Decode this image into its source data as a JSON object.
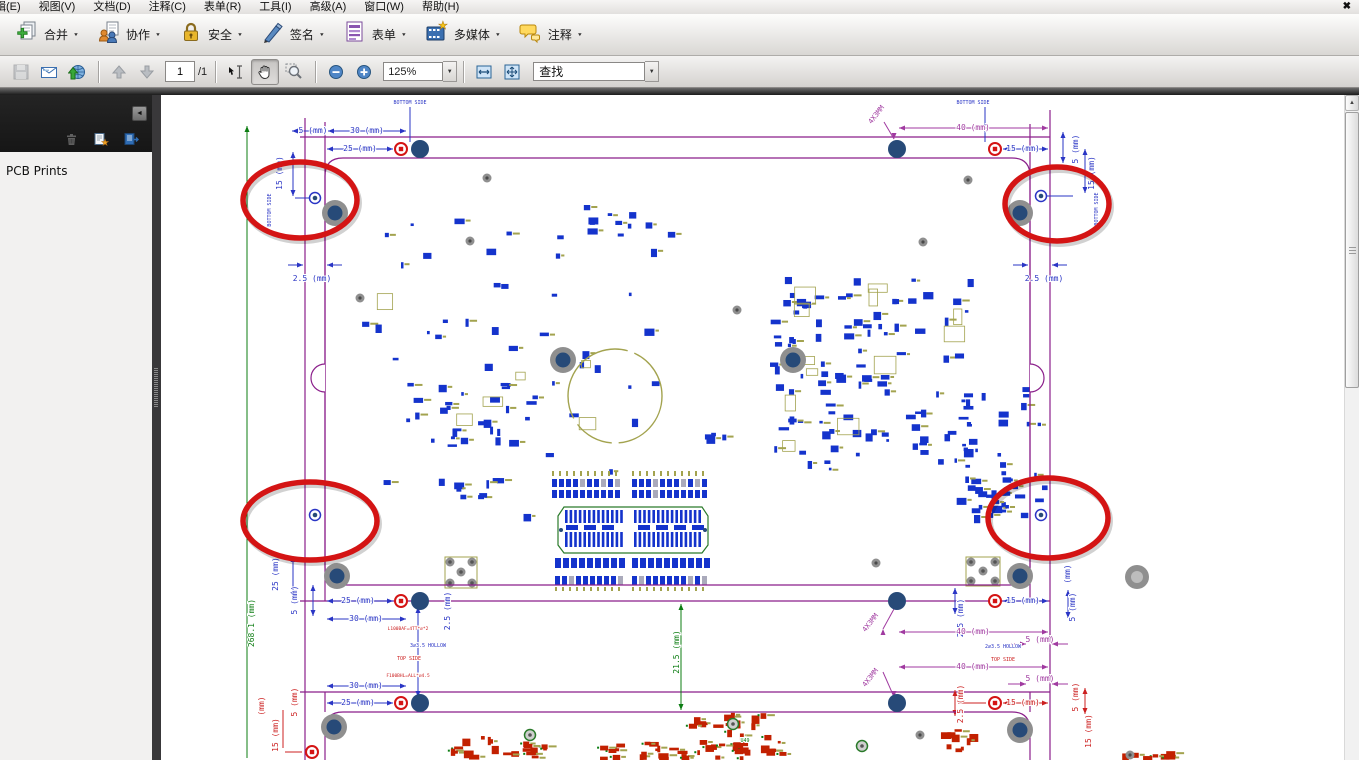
{
  "menu_bar": {
    "items": [
      "辑(E)",
      "视图(V)",
      "文档(D)",
      "注释(C)",
      "表单(R)",
      "工具(I)",
      "高级(A)",
      "窗口(W)",
      "帮助(H)"
    ],
    "close_glyph": "✖"
  },
  "toolbar_main": {
    "items": [
      {
        "id": "combine",
        "label": "合并"
      },
      {
        "id": "collaborate",
        "label": "协作"
      },
      {
        "id": "secure",
        "label": "安全"
      },
      {
        "id": "sign",
        "label": "签名"
      },
      {
        "id": "forms",
        "label": "表单"
      },
      {
        "id": "multimedia",
        "label": "多媒体"
      },
      {
        "id": "comment",
        "label": "注释"
      }
    ],
    "dropdown_glyph": "▼"
  },
  "toolbar_nav": {
    "page_current": "1",
    "page_total": "/1",
    "zoom_level": "125%",
    "find_value": "查找"
  },
  "sidebar": {
    "panel_title": "PCB Prints"
  },
  "drawing": {
    "palette": {
      "B": "#2a35c5",
      "P": "#a03aa0",
      "M": "#8b1f8b",
      "G": "#0c7d12",
      "R": "#cc2020",
      "O": "#a3a34f",
      "A": "#d41414",
      "N": "#274a78",
      "H": "#8f8f8f"
    },
    "labels": [
      {
        "t": "BOTTOM SIDE",
        "x": 410,
        "y": 104,
        "c": "B",
        "s": 5
      },
      {
        "t": "5 (mm)",
        "x": 313,
        "y": 133,
        "c": "B",
        "s": 8
      },
      {
        "t": "30 (mm)",
        "x": 367,
        "y": 133,
        "c": "B",
        "s": 8
      },
      {
        "t": "25 (mm)",
        "x": 360,
        "y": 151,
        "c": "B",
        "s": 8
      },
      {
        "t": "15 (mm)",
        "x": 282,
        "y": 173,
        "r": -90,
        "c": "B",
        "s": 8
      },
      {
        "t": "BOTTOM SIDE",
        "x": 271,
        "y": 210,
        "r": -90,
        "c": "B",
        "s": 5
      },
      {
        "t": "2.5 (mm)",
        "x": 312,
        "y": 281,
        "c": "B",
        "s": 8
      },
      {
        "t": "BOTTOM SIDE",
        "x": 973,
        "y": 104,
        "c": "B",
        "s": 5
      },
      {
        "t": "40 (mm)",
        "x": 973,
        "y": 130,
        "c": "P",
        "s": 8
      },
      {
        "t": "4X3MM",
        "x": 878,
        "y": 116,
        "r": -52,
        "c": "P",
        "s": 7
      },
      {
        "t": "15 (mm)",
        "x": 1023,
        "y": 151,
        "c": "B",
        "s": 8
      },
      {
        "t": "5 (mm)",
        "x": 1078,
        "y": 149,
        "r": -90,
        "c": "B",
        "s": 8
      },
      {
        "t": "15 (mm)",
        "x": 1094,
        "y": 173,
        "r": -90,
        "c": "B",
        "s": 8
      },
      {
        "t": "BOTTOM SIDE",
        "x": 1098,
        "y": 209,
        "r": -90,
        "c": "B",
        "s": 5
      },
      {
        "t": "2.5 (mm)",
        "x": 1044,
        "y": 281,
        "c": "B",
        "s": 8
      },
      {
        "t": "25 (mm)",
        "x": 278,
        "y": 574,
        "r": -90,
        "c": "B",
        "s": 8
      },
      {
        "t": "5 (mm)",
        "x": 297,
        "y": 600,
        "r": -90,
        "c": "B",
        "s": 8
      },
      {
        "t": "25 (mm)",
        "x": 358,
        "y": 603,
        "c": "B",
        "s": 8
      },
      {
        "t": "30 (mm)",
        "x": 366,
        "y": 621,
        "c": "B",
        "s": 8
      },
      {
        "t": "2.5 (mm)",
        "x": 450,
        "y": 611,
        "r": -90,
        "c": "B",
        "s": 8
      },
      {
        "t": "L100BAF=4TT*⌀*2",
        "x": 408,
        "y": 630,
        "c": "R",
        "s": 4.5
      },
      {
        "t": "3⌀3.5 HOLLOW",
        "x": 428,
        "y": 647,
        "c": "B",
        "s": 5
      },
      {
        "t": "TOP SIDE",
        "x": 409,
        "y": 660,
        "c": "R",
        "s": 5
      },
      {
        "t": "F100BHL=ALL*⌀4.5",
        "x": 408,
        "y": 677,
        "c": "R",
        "s": 4.5
      },
      {
        "t": "268.1 (mm)",
        "x": 254,
        "y": 623,
        "r": -90,
        "c": "G",
        "s": 8
      },
      {
        "t": "30 (mm)",
        "x": 366,
        "y": 688,
        "c": "B",
        "s": 8
      },
      {
        "t": "25 (mm)",
        "x": 358,
        "y": 705,
        "c": "B",
        "s": 8
      },
      {
        "t": "5 (mm)",
        "x": 297,
        "y": 702,
        "r": -90,
        "c": "R",
        "s": 8
      },
      {
        "t": "(mm)",
        "x": 264,
        "y": 706,
        "r": -90,
        "c": "R",
        "s": 8
      },
      {
        "t": "15 (mm)",
        "x": 278,
        "y": 735,
        "r": -90,
        "c": "R",
        "s": 8
      },
      {
        "t": "21.5 (mm)",
        "x": 679,
        "y": 652,
        "r": -90,
        "c": "G",
        "s": 8
      },
      {
        "t": "15 (mm)",
        "x": 1023,
        "y": 603,
        "c": "B",
        "s": 8
      },
      {
        "t": "2.5 (mm)",
        "x": 963,
        "y": 618,
        "r": -90,
        "c": "B",
        "s": 8
      },
      {
        "t": "5 (mm)",
        "x": 1075,
        "y": 607,
        "r": -90,
        "c": "B",
        "s": 8
      },
      {
        "t": "(mm)",
        "x": 1070,
        "y": 574,
        "r": -90,
        "c": "B",
        "s": 8
      },
      {
        "t": "40 (mm)",
        "x": 973,
        "y": 634,
        "c": "P",
        "s": 8
      },
      {
        "t": "4X3MM",
        "x": 872,
        "y": 624,
        "r": -52,
        "c": "P",
        "s": 7
      },
      {
        "t": "5 (mm)",
        "x": 1040,
        "y": 642,
        "c": "P",
        "s": 8
      },
      {
        "t": "2⌀3.5 HOLLOW",
        "x": 1003,
        "y": 648,
        "c": "B",
        "s": 5
      },
      {
        "t": "TOP SIDE",
        "x": 1003,
        "y": 661,
        "c": "R",
        "s": 5
      },
      {
        "t": "40 (mm)",
        "x": 973,
        "y": 669,
        "c": "P",
        "s": 8
      },
      {
        "t": "4X3MM",
        "x": 872,
        "y": 679,
        "r": -52,
        "c": "P",
        "s": 7
      },
      {
        "t": "5 (mm)",
        "x": 1040,
        "y": 681,
        "c": "P",
        "s": 8
      },
      {
        "t": "15 (mm)",
        "x": 1023,
        "y": 705,
        "c": "R",
        "s": 8
      },
      {
        "t": "2.5 (mm)",
        "x": 963,
        "y": 704,
        "r": -90,
        "c": "R",
        "s": 8
      },
      {
        "t": "5 (mm)",
        "x": 1078,
        "y": 697,
        "r": -90,
        "c": "R",
        "s": 8
      },
      {
        "t": "15 (mm)",
        "x": 1091,
        "y": 731,
        "r": -90,
        "c": "R",
        "s": 8
      },
      {
        "t": "U49",
        "x": 745,
        "y": 742,
        "c": "G",
        "s": 5
      }
    ]
  }
}
